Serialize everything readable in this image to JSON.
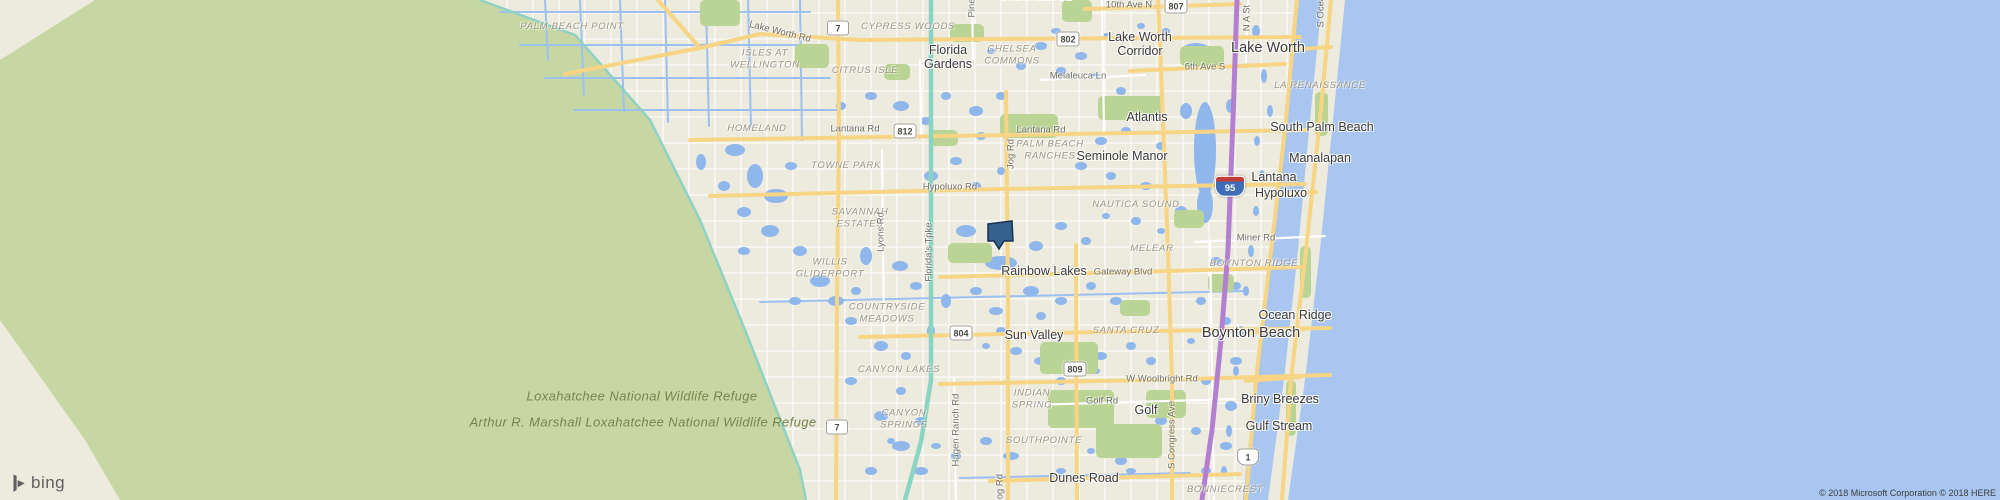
{
  "attribution": {
    "logo": "bing",
    "copyright": "© 2018 Microsoft Corporation © 2018 HERE"
  },
  "marker": {
    "name": "property-location-marker",
    "x": 1000,
    "y": 236
  },
  "colors": {
    "land": "#edeade",
    "water": "#a8c6f0",
    "refuge_green": "#c7d7a3",
    "park_green": "#b9d494",
    "lake_blue": "#8fb7ec",
    "road_yellow": "#f7d584",
    "road_white": "#ffffff",
    "turnpike_teal": "#8bd3c3",
    "interstate_purple": "#b37fd0",
    "marker_fill": "#35618f",
    "marker_stroke": "#1a3150"
  },
  "labels": {
    "cities": [
      {
        "text": "Greenacres",
        "x": 1035,
        "y": -4,
        "big": true
      },
      {
        "text": "Florida\nGardens",
        "x": 948,
        "y": 57
      },
      {
        "text": "Lake Worth\nCorridor",
        "x": 1140,
        "y": 44
      },
      {
        "text": "Lake Worth",
        "x": 1268,
        "y": 48,
        "big": true
      },
      {
        "text": "Atlantis",
        "x": 1147,
        "y": 117
      },
      {
        "text": "Seminole Manor",
        "x": 1122,
        "y": 156
      },
      {
        "text": "South Palm Beach",
        "x": 1322,
        "y": 127
      },
      {
        "text": "Manalapan",
        "x": 1320,
        "y": 158
      },
      {
        "text": "Lantana",
        "x": 1274,
        "y": 177
      },
      {
        "text": "Hypoluxo",
        "x": 1281,
        "y": 193
      },
      {
        "text": "Rainbow Lakes",
        "x": 1044,
        "y": 271
      },
      {
        "text": "Sun Valley",
        "x": 1034,
        "y": 335
      },
      {
        "text": "Boynton Beach",
        "x": 1251,
        "y": 333,
        "big": true
      },
      {
        "text": "Ocean Ridge",
        "x": 1295,
        "y": 315
      },
      {
        "text": "Briny Breezes",
        "x": 1280,
        "y": 399
      },
      {
        "text": "Gulf Stream",
        "x": 1279,
        "y": 426
      },
      {
        "text": "Golf",
        "x": 1146,
        "y": 410
      },
      {
        "text": "Dunes Road",
        "x": 1084,
        "y": 478
      }
    ],
    "neighborhoods": [
      {
        "text": "PALM BEACH POINT",
        "x": 572,
        "y": 27
      },
      {
        "text": "ISLES AT\nWELLINGTON",
        "x": 765,
        "y": 60
      },
      {
        "text": "CITRUS ISLE",
        "x": 865,
        "y": 71
      },
      {
        "text": "CYPRESS WOODS",
        "x": 908,
        "y": 27
      },
      {
        "text": "CHELSEA\nCOMMONS",
        "x": 1012,
        "y": 56
      },
      {
        "text": "HOMELAND",
        "x": 757,
        "y": 129
      },
      {
        "text": "TOWNE PARK",
        "x": 846,
        "y": 166
      },
      {
        "text": "SAVANNAH\nESTATES",
        "x": 860,
        "y": 219
      },
      {
        "text": "WILLIS\nGLIDERPORT",
        "x": 830,
        "y": 269
      },
      {
        "text": "COUNTRYSIDE\nMEADOWS",
        "x": 887,
        "y": 314
      },
      {
        "text": "CANYON LAKES",
        "x": 899,
        "y": 370
      },
      {
        "text": "CANYON\nSPRINGS",
        "x": 904,
        "y": 420
      },
      {
        "text": "PALM BEACH\nRANCHES",
        "x": 1050,
        "y": 151
      },
      {
        "text": "NAUTICA SOUND",
        "x": 1136,
        "y": 205
      },
      {
        "text": "MELEAR",
        "x": 1152,
        "y": 249
      },
      {
        "text": "BOYNTON RIDGE",
        "x": 1254,
        "y": 264
      },
      {
        "text": "SANTA CRUZ",
        "x": 1126,
        "y": 331
      },
      {
        "text": "INDIAN\nSPRING",
        "x": 1032,
        "y": 400
      },
      {
        "text": "SOUTHPOINTE",
        "x": 1044,
        "y": 441
      },
      {
        "text": "BONNIECREST",
        "x": 1225,
        "y": 490
      },
      {
        "text": "LA RENAISSANCE",
        "x": 1320,
        "y": 86
      }
    ],
    "refuge_labels": [
      {
        "text": "Loxahatchee National Wildlife Refuge",
        "x": 642,
        "y": 396
      },
      {
        "text": "Arthur R. Marshall Loxahatchee National Wildlife Refuge",
        "x": 643,
        "y": 422
      }
    ],
    "roads": [
      {
        "text": "Lake Worth Rd",
        "x": 780,
        "y": 32,
        "rot": 14
      },
      {
        "text": "10th Ave N",
        "x": 1129,
        "y": 5
      },
      {
        "text": "6th Ave S",
        "x": 1205,
        "y": 67
      },
      {
        "text": "Melaleuca Ln",
        "x": 1078,
        "y": 76
      },
      {
        "text": "Lantana Rd",
        "x": 855,
        "y": 129
      },
      {
        "text": "Lantana Rd",
        "x": 1041,
        "y": 130
      },
      {
        "text": "Hypoluxo Rd",
        "x": 950,
        "y": 187
      },
      {
        "text": "Miner Rd",
        "x": 1256,
        "y": 238
      },
      {
        "text": "Gateway Blvd",
        "x": 1123,
        "y": 272
      },
      {
        "text": "W Woolbright Rd",
        "x": 1162,
        "y": 379
      },
      {
        "text": "Golf Rd",
        "x": 1102,
        "y": 401
      }
    ],
    "roads_vertical": [
      {
        "text": "Pine",
        "x": 972,
        "y": 8
      },
      {
        "text": "N A St",
        "x": 1247,
        "y": 18
      },
      {
        "text": "S Ocean",
        "x": 1321,
        "y": 9
      },
      {
        "text": "Lyons Rd",
        "x": 881,
        "y": 232
      },
      {
        "text": "Florida's Tpke",
        "x": 929,
        "y": 252
      },
      {
        "text": "Jog Rd",
        "x": 1011,
        "y": 154
      },
      {
        "text": "Jog Rd",
        "x": 1000,
        "y": 489
      },
      {
        "text": "Hagen Ranch Rd",
        "x": 956,
        "y": 430
      },
      {
        "text": "S Congress Ave",
        "x": 1172,
        "y": 435
      }
    ]
  },
  "shields": [
    {
      "kind": "state",
      "label": "7",
      "x": 838,
      "y": 28
    },
    {
      "kind": "state",
      "label": "802",
      "x": 1068,
      "y": 39
    },
    {
      "kind": "state",
      "label": "807",
      "x": 1176,
      "y": 6
    },
    {
      "kind": "state",
      "label": "812",
      "x": 905,
      "y": 131
    },
    {
      "kind": "state",
      "label": "804",
      "x": 961,
      "y": 333
    },
    {
      "kind": "state",
      "label": "809",
      "x": 1075,
      "y": 369
    },
    {
      "kind": "state",
      "label": "7",
      "x": 837,
      "y": 427
    },
    {
      "kind": "us",
      "label": "1",
      "x": 1248,
      "y": 457
    },
    {
      "kind": "interstate",
      "label": "95",
      "x": 1230,
      "y": 186
    }
  ]
}
